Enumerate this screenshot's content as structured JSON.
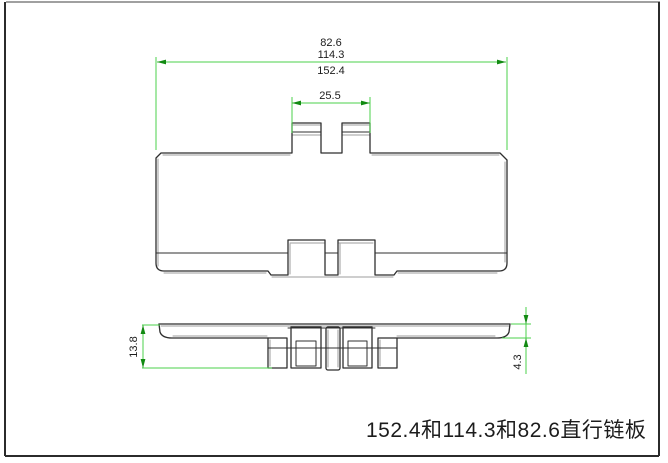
{
  "title": {
    "text": "152.4和114.3和82.6直行链板"
  },
  "dimensions": {
    "width_stack": {
      "labels": [
        "82.6",
        "114.3",
        "152.4"
      ],
      "description": "overall plate widths"
    },
    "tab_span": {
      "label": "25.5"
    },
    "side_height": {
      "label": "13.8"
    },
    "plate_thickness": {
      "label": "4.3"
    }
  },
  "colors": {
    "background": "#ffffff",
    "part_line": "#2f2f2f",
    "part_shadow": "#9c9c9c",
    "dimension_line": "#4bd24b",
    "arrow": "#128a12",
    "text": "#1c1c1c",
    "frame_dark": "#2b2b2b",
    "frame_light": "#a0a0a0"
  }
}
